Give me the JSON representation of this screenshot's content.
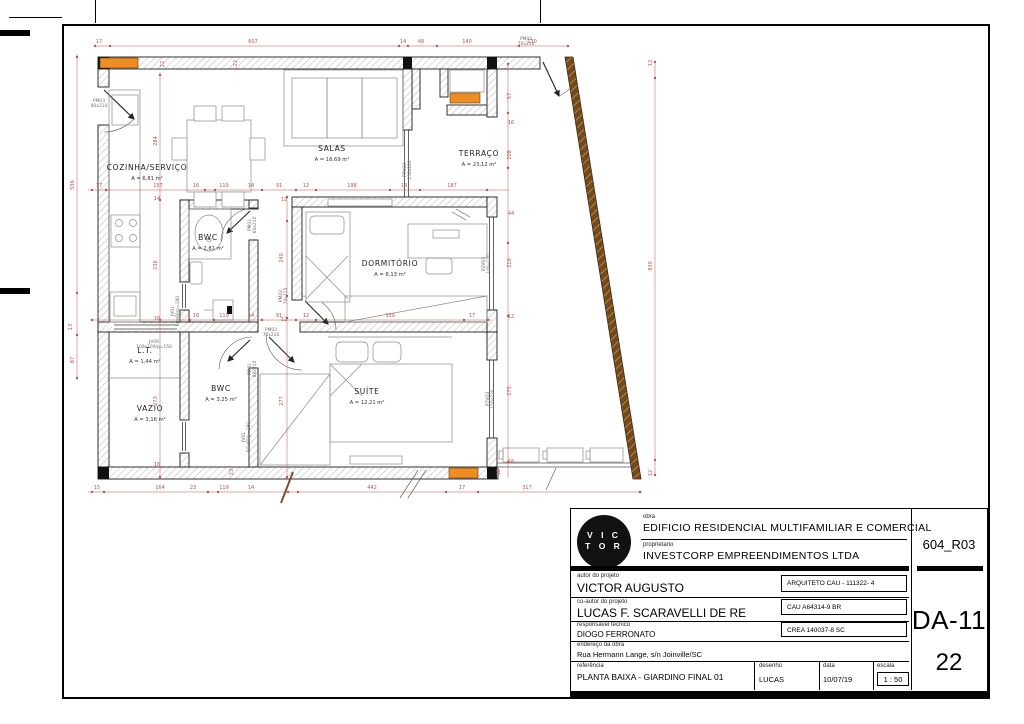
{
  "title_block": {
    "logo_line1": "V I C",
    "logo_line2": "T O R",
    "obra_label": "obra",
    "obra": "EDIFICIO RESIDENCIAL MULTIFAMILIAR E COMERCIAL",
    "proprietario_label": "proprietario",
    "proprietario": "INVESTCORP EMPREENDIMENTOS LTDA",
    "autor_label": "autor do projeto",
    "autor": "VICTOR AUGUSTO",
    "autor_reg": "ARQUITETO CAU - 111322- 4",
    "coautor_label": "co-autor do projeto",
    "coautor": "LUCAS F. SCARAVELLI DE RE",
    "coautor_reg": "CAU A64314-9 BR",
    "resp_label": "responsável técnico",
    "resp": "DIOGO FERRONATO",
    "resp_reg": "CREA 140037-8 SC",
    "endereco_label": "endereço da obra",
    "endereco": "Rua Hermann Lange, s/n Joinville/SC",
    "referencia_label": "referência",
    "referencia": "PLANTA BAIXA - GIARDINO FINAL 01",
    "desenho_label": "desenho",
    "desenho": "LUCAS",
    "data_label": "data",
    "data": "10/07/19",
    "escala_label": "escala",
    "escala": "1 : 50",
    "revision": "604_R03",
    "sheet_code": "DA-11",
    "sheet_number": "22"
  },
  "plan": {
    "colors": {
      "dimension": "#c0504d",
      "accent_orange": "#ef8d22",
      "facade_wood": "#6f4a22"
    },
    "rooms": [
      {
        "name": "COZINHA/SERVIÇO",
        "area": "A = 6,81 m²",
        "x": 147,
        "y": 170
      },
      {
        "name": "SALAS",
        "area": "A = 16,69 m²",
        "x": 332,
        "y": 151
      },
      {
        "name": "TERRAÇO",
        "area": "A = 23,12 m²",
        "x": 479,
        "y": 156
      },
      {
        "name": "BWC",
        "area": "A = 2,81 m²",
        "x": 208,
        "y": 240
      },
      {
        "name": "DORMITÓRIO",
        "area": "A = 8,13 m²",
        "x": 390,
        "y": 266
      },
      {
        "name": "L.T.",
        "area": "A = 1,44 m²",
        "x": 145,
        "y": 353
      },
      {
        "name": "VAZIO",
        "area": "A = 3,16 m²",
        "x": 150,
        "y": 411
      },
      {
        "name": "BWC",
        "area": "A = 3,25 m²",
        "x": 221,
        "y": 391
      },
      {
        "name": "SUÍTE",
        "area": "A = 12,21 m²",
        "x": 367,
        "y": 394
      }
    ],
    "dims": [
      {
        "t": "17",
        "x": 99,
        "y": 43
      },
      {
        "t": "607",
        "x": 253,
        "y": 43
      },
      {
        "t": "14",
        "x": 403,
        "y": 43
      },
      {
        "t": "48",
        "x": 421,
        "y": 43
      },
      {
        "t": "140",
        "x": 467,
        "y": 43
      },
      {
        "t": "130",
        "x": 532,
        "y": 43
      },
      {
        "t": "17",
        "x": 99,
        "y": 187
      },
      {
        "t": "157",
        "x": 158,
        "y": 187
      },
      {
        "t": "16",
        "x": 196,
        "y": 187
      },
      {
        "t": "119",
        "x": 224,
        "y": 187
      },
      {
        "t": "14",
        "x": 251,
        "y": 187
      },
      {
        "t": "91",
        "x": 279,
        "y": 187
      },
      {
        "t": "12",
        "x": 306,
        "y": 187
      },
      {
        "t": "198",
        "x": 352,
        "y": 187
      },
      {
        "t": "14",
        "x": 404,
        "y": 187
      },
      {
        "t": "187",
        "x": 452,
        "y": 187
      },
      {
        "t": "16",
        "x": 196,
        "y": 317
      },
      {
        "t": "119",
        "x": 224,
        "y": 317
      },
      {
        "t": "14",
        "x": 251,
        "y": 317
      },
      {
        "t": "91",
        "x": 279,
        "y": 317
      },
      {
        "t": "12",
        "x": 306,
        "y": 317
      },
      {
        "t": "339",
        "x": 390,
        "y": 317
      },
      {
        "t": "17",
        "x": 472,
        "y": 317
      },
      {
        "t": "15",
        "x": 97,
        "y": 489
      },
      {
        "t": "164",
        "x": 160,
        "y": 489
      },
      {
        "t": "23",
        "x": 193,
        "y": 489
      },
      {
        "t": "119",
        "x": 224,
        "y": 489
      },
      {
        "t": "14",
        "x": 251,
        "y": 489
      },
      {
        "t": "442",
        "x": 372,
        "y": 489
      },
      {
        "t": "17",
        "x": 462,
        "y": 489
      },
      {
        "t": "317",
        "x": 527,
        "y": 489
      },
      {
        "t": "536",
        "x": 74,
        "y": 185,
        "r": 1
      },
      {
        "t": "13",
        "x": 72,
        "y": 327,
        "r": 1
      },
      {
        "t": "87",
        "x": 74,
        "y": 360,
        "r": 1
      },
      {
        "t": "22",
        "x": 164,
        "y": 64,
        "r": 1
      },
      {
        "t": "284",
        "x": 157,
        "y": 141,
        "r": 1
      },
      {
        "t": "14",
        "x": 157,
        "y": 200
      },
      {
        "t": "236",
        "x": 157,
        "y": 265,
        "r": 1
      },
      {
        "t": "16",
        "x": 157,
        "y": 320
      },
      {
        "t": "273",
        "x": 157,
        "y": 401,
        "r": 1
      },
      {
        "t": "16",
        "x": 157,
        "y": 466
      },
      {
        "t": "12",
        "x": 284,
        "y": 201
      },
      {
        "t": "240",
        "x": 283,
        "y": 258,
        "r": 1
      },
      {
        "t": "12",
        "x": 284,
        "y": 321
      },
      {
        "t": "277",
        "x": 283,
        "y": 401,
        "r": 1
      },
      {
        "t": "57",
        "x": 511,
        "y": 96,
        "r": 1
      },
      {
        "t": "16",
        "x": 511,
        "y": 124
      },
      {
        "t": "208",
        "x": 511,
        "y": 155,
        "r": 1
      },
      {
        "t": "44",
        "x": 511,
        "y": 215
      },
      {
        "t": "210",
        "x": 511,
        "y": 263,
        "r": 1
      },
      {
        "t": "12",
        "x": 511,
        "y": 318
      },
      {
        "t": "275",
        "x": 511,
        "y": 391,
        "r": 1
      },
      {
        "t": "16",
        "x": 511,
        "y": 463
      },
      {
        "t": "12",
        "x": 652,
        "y": 63,
        "r": 1
      },
      {
        "t": "830",
        "x": 652,
        "y": 266,
        "r": 1
      },
      {
        "t": "12",
        "x": 652,
        "y": 473,
        "r": 1
      },
      {
        "t": "22",
        "x": 237,
        "y": 63,
        "r": 1
      },
      {
        "t": "23",
        "x": 233,
        "y": 472,
        "r": 1
      },
      {
        "t": "12",
        "x": 500,
        "y": 472,
        "r": 1
      }
    ],
    "opening_tags": [
      {
        "l1": "PM03",
        "l2": "80x210",
        "x": 99,
        "y": 102
      },
      {
        "l1": "PM01",
        "l2": "60x210",
        "x": 251,
        "y": 225,
        "r": 1
      },
      {
        "l1": "JV01",
        "l2": "60x60/p=180",
        "x": 174,
        "y": 311,
        "r": 1
      },
      {
        "l1": "PM02",
        "l2": "70x210",
        "x": 271,
        "y": 331
      },
      {
        "l1": "PM02",
        "l2": "70x210",
        "x": 282,
        "y": 296,
        "r": 1
      },
      {
        "l1": "P7V03",
        "l2": "150x220",
        "x": 406,
        "y": 170,
        "r": 1
      },
      {
        "l1": "P2V03",
        "l2": "100x220",
        "x": 485,
        "y": 264,
        "r": 1
      },
      {
        "l1": "P7V03",
        "l2": "150x220",
        "x": 489,
        "y": 399,
        "r": 1
      },
      {
        "l1": "JV09",
        "l2": "100x100/p=150",
        "x": 154,
        "y": 343
      },
      {
        "l1": "PM01",
        "l2": "80x210",
        "x": 251,
        "y": 369,
        "r": 1
      },
      {
        "l1": "JV01",
        "l2": "60x60/p=180",
        "x": 245,
        "y": 437,
        "r": 1
      },
      {
        "l1": "PM02",
        "l2": "70x210",
        "x": 526,
        "y": 40
      }
    ]
  }
}
